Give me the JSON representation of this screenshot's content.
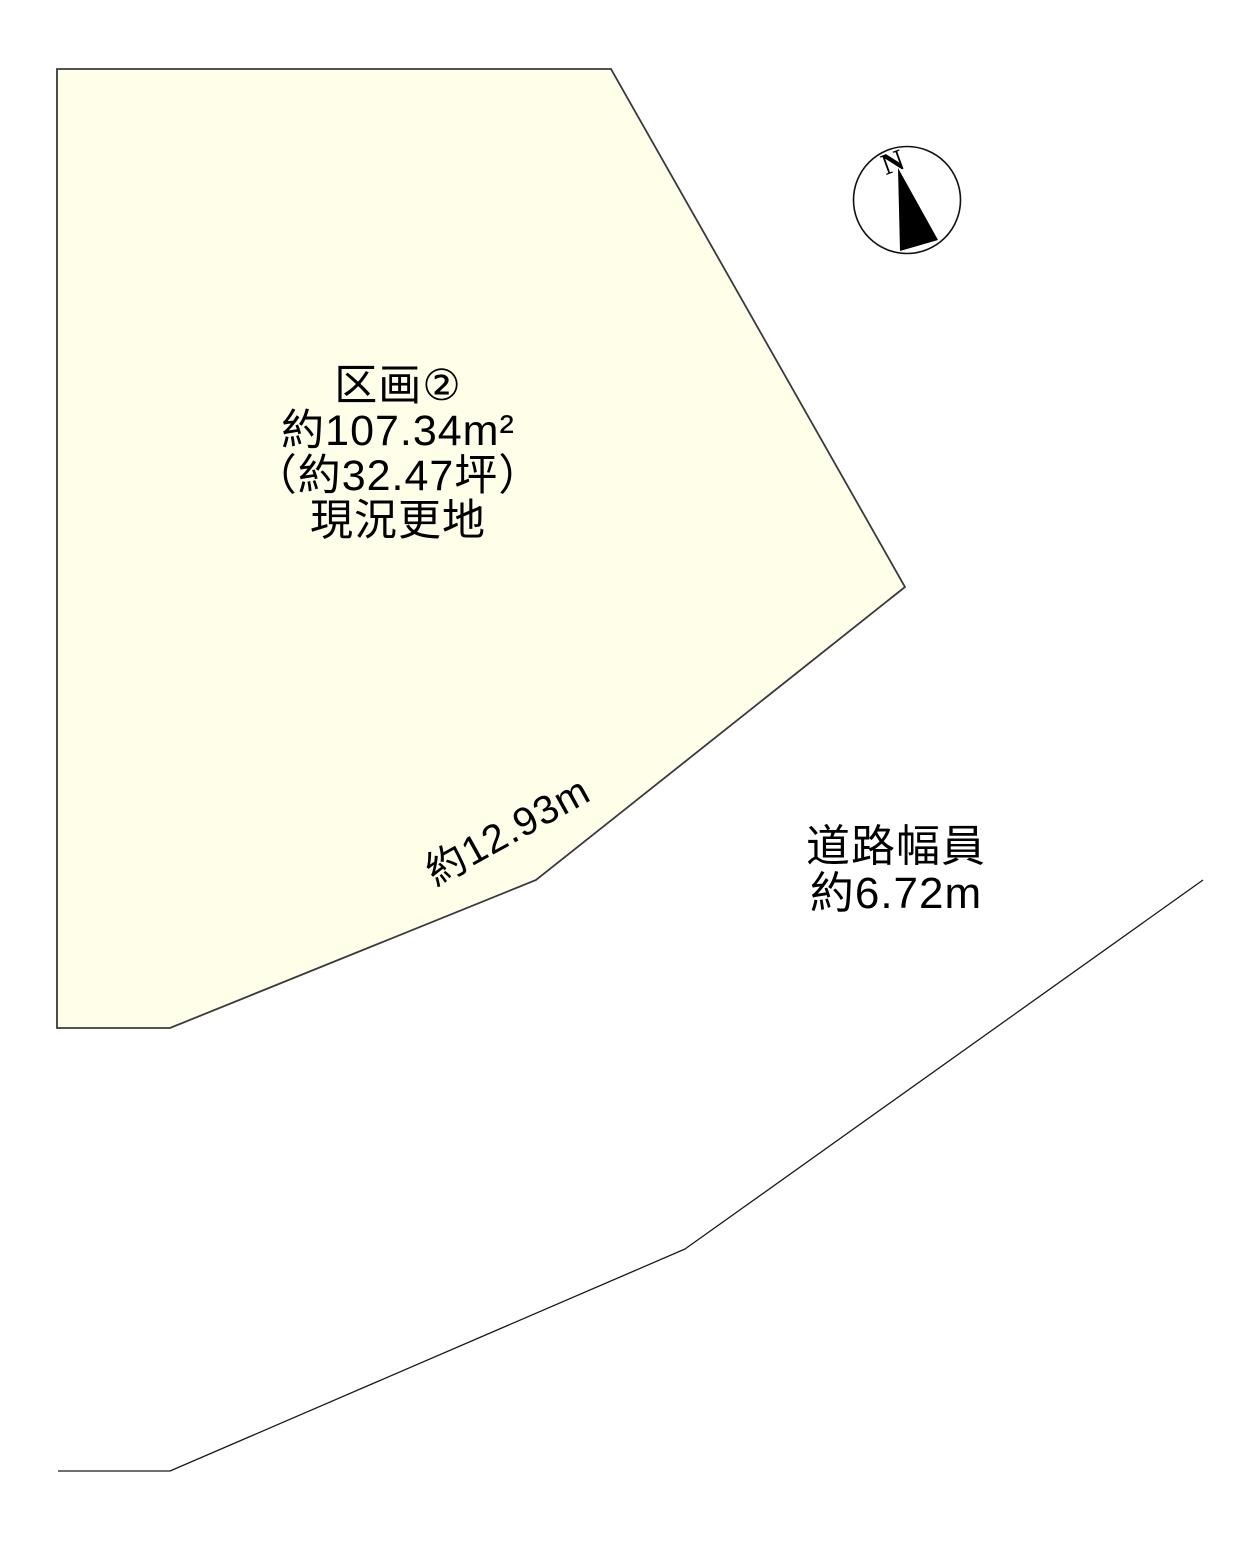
{
  "colors": {
    "page_background": "#ffffff",
    "parcel_fill": "#fefee9",
    "parcel_outline": "#3a3a3a",
    "road_line": "#1a1a1a",
    "text": "#000000"
  },
  "parcel": {
    "title": "区画②",
    "area_sqm": "約107.34m²",
    "area_tsubo": "（約32.47坪）",
    "condition": "現況更地",
    "frontage_label": "約12.93m"
  },
  "road": {
    "width_label_line1": "道路幅員",
    "width_label_line2": "約6.72m"
  },
  "compass": {
    "north_label": "N"
  }
}
